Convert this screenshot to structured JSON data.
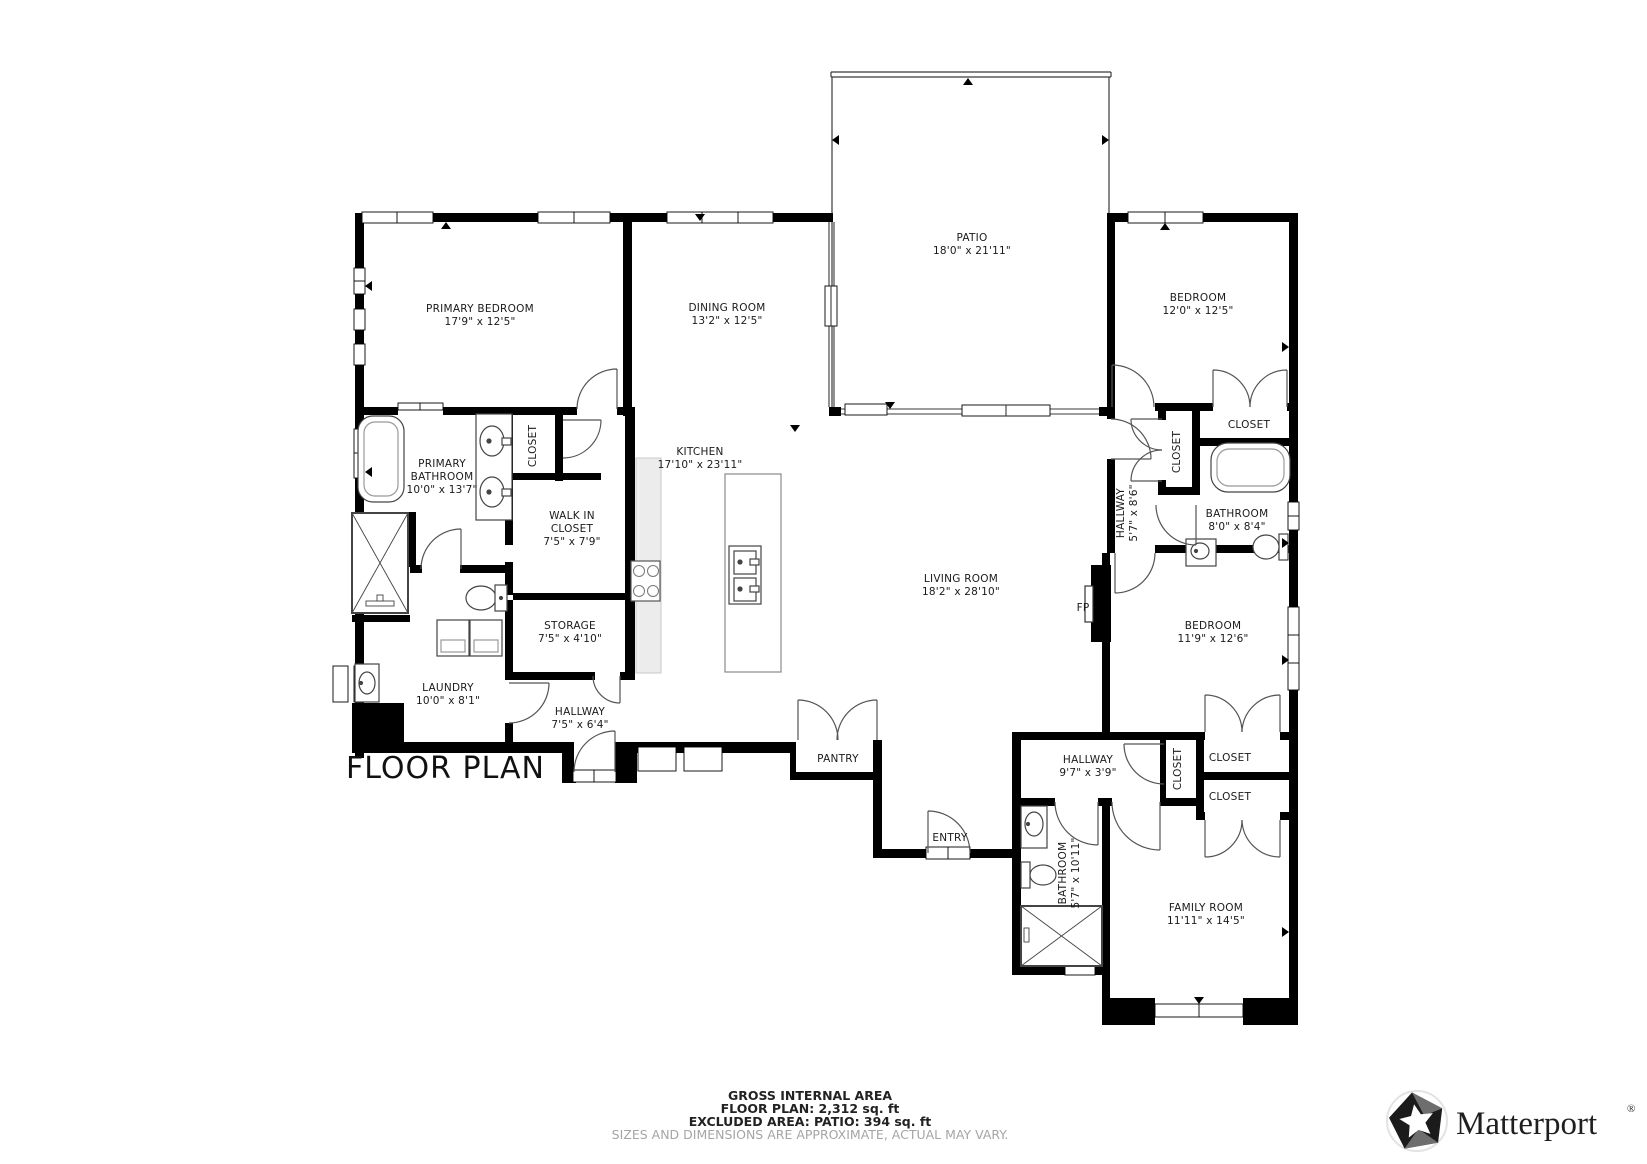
{
  "plan": {
    "title": "FLOOR PLAN"
  },
  "rooms": [
    {
      "id": "primary-bedroom",
      "lines": [
        "PRIMARY BEDROOM",
        "17'9\" x 12'5\""
      ]
    },
    {
      "id": "dining-room",
      "lines": [
        "DINING ROOM",
        "13'2\" x 12'5\""
      ]
    },
    {
      "id": "patio",
      "lines": [
        "PATIO",
        "18'0\" x 21'11\""
      ]
    },
    {
      "id": "bedroom-top",
      "lines": [
        "BEDROOM",
        "12'0\" x 12'5\""
      ]
    },
    {
      "id": "kitchen",
      "lines": [
        "KITCHEN",
        "17'10\" x 23'11\""
      ]
    },
    {
      "id": "primary-bathroom",
      "lines": [
        "PRIMARY",
        "BATHROOM",
        "10'0\" x 13'7\""
      ]
    },
    {
      "id": "closet-primary",
      "lines": [
        "CLOSET"
      ]
    },
    {
      "id": "walk-in-closet",
      "lines": [
        "WALK IN",
        "CLOSET",
        "7'5\" x 7'9\""
      ]
    },
    {
      "id": "storage",
      "lines": [
        "STORAGE",
        "7'5\" x 4'10\""
      ]
    },
    {
      "id": "laundry",
      "lines": [
        "LAUNDRY",
        "10'0\" x 8'1\""
      ]
    },
    {
      "id": "hallway-west",
      "lines": [
        "HALLWAY",
        "7'5\" x 6'4\""
      ]
    },
    {
      "id": "living-room",
      "lines": [
        "LIVING ROOM",
        "18'2\" x 28'10\""
      ]
    },
    {
      "id": "hallway-east",
      "lines": [
        "HALLWAY",
        "5'7\" x 8'6\""
      ]
    },
    {
      "id": "closet-hall-east",
      "lines": [
        "CLOSET"
      ]
    },
    {
      "id": "closet-bedroom",
      "lines": [
        "CLOSET"
      ]
    },
    {
      "id": "bathroom-east",
      "lines": [
        "BATHROOM",
        "8'0\" x 8'4\""
      ]
    },
    {
      "id": "bedroom-mid",
      "lines": [
        "BEDROOM",
        "11'9\" x 12'6\""
      ]
    },
    {
      "id": "fireplace",
      "lines": [
        "FP"
      ]
    },
    {
      "id": "pantry",
      "lines": [
        "PANTRY"
      ]
    },
    {
      "id": "hallway-south",
      "lines": [
        "HALLWAY",
        "9'7\" x 3'9\""
      ]
    },
    {
      "id": "closet-south",
      "lines": [
        "CLOSET"
      ]
    },
    {
      "id": "closet-family-1",
      "lines": [
        "CLOSET"
      ]
    },
    {
      "id": "closet-family-2",
      "lines": [
        "CLOSET"
      ]
    },
    {
      "id": "entry",
      "lines": [
        "ENTRY"
      ]
    },
    {
      "id": "bathroom-south",
      "lines": [
        "BATHROOM",
        "5'7\" x 10'11\""
      ]
    },
    {
      "id": "family-room",
      "lines": [
        "FAMILY ROOM",
        "11'11\" x 14'5\""
      ]
    }
  ],
  "footer": {
    "heading": "GROSS INTERNAL AREA",
    "floor_plan_area": "FLOOR PLAN: 2,312 sq. ft",
    "excluded_area": "EXCLUDED AREA: PATIO: 394 sq. ft",
    "disclaimer": "SIZES AND DIMENSIONS ARE APPROXIMATE, ACTUAL MAY VARY."
  },
  "brand": {
    "name": "Matterport",
    "registered_mark": "®"
  },
  "colors": {
    "walls": "#000000",
    "background": "#ffffff",
    "counter": "#ececec",
    "label_text": "#1a1a1a",
    "disclaimer_text": "#a5a5a5",
    "thin_line": "#3a3a3a"
  },
  "fixtures": [
    "bathtub",
    "shower",
    "toilet",
    "sink",
    "double-vanity",
    "kitchen-island",
    "stove",
    "washer-dryer",
    "fireplace",
    "pantry-shelf",
    "door-swing",
    "double-door-swing",
    "window",
    "sliding-glass-door"
  ]
}
